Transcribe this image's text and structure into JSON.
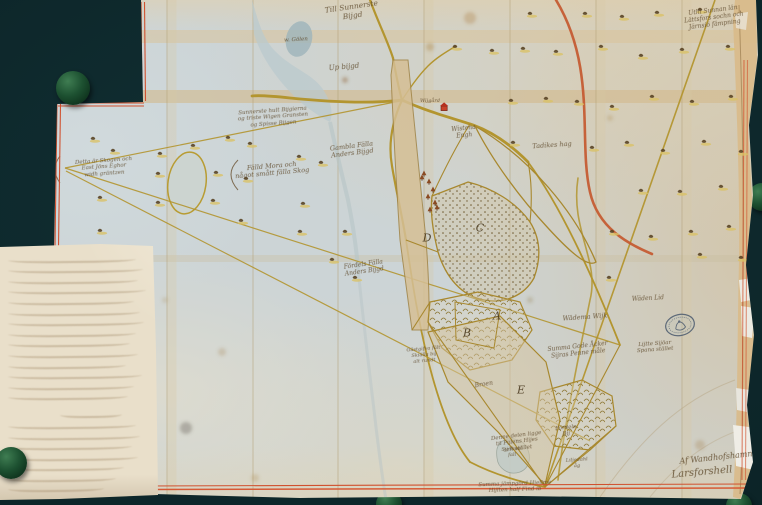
{
  "palette": {
    "background": "#081c1f",
    "background_highlight": "#123135",
    "paper_blue": "#ccd4d6",
    "paper_cream": "#e2cba0",
    "note_cream": "#e9dfca",
    "border_red": "#d0512f",
    "road_yellow": "#b3952f",
    "road_red": "#c55c33",
    "ink_brown": "#5f4a2c",
    "disc_green": "#1d5131",
    "stamp_blue": "#4a5a6e"
  },
  "map_sheet": {
    "labels": [
      {
        "x": 352,
        "y": 3,
        "s": 7.5,
        "r": -8,
        "lines": [
          "Till Sunnerste",
          "Bijgd"
        ]
      },
      {
        "x": 714,
        "y": 8,
        "s": 6,
        "r": -7,
        "lines": [
          "Uthi Sunnan län",
          "Lättsfors sochn och",
          "Järnsiö fämpning"
        ]
      },
      {
        "x": 344,
        "y": 63,
        "s": 7,
        "r": -5,
        "lines": [
          "Up bijgd"
        ]
      },
      {
        "x": 296,
        "y": 37,
        "s": 5.5,
        "r": -3,
        "lines": [
          "w. Gölen"
        ]
      },
      {
        "x": 273,
        "y": 108,
        "s": 5.5,
        "r": -4,
        "lines": [
          "Sunnerste hult Bijgierna",
          "og triste Wigen Gransten",
          "og Spisse Bijgen"
        ]
      },
      {
        "x": 104,
        "y": 158,
        "s": 5.5,
        "r": -4,
        "lines": [
          "Detta är Skogen och",
          "East Jöns Eghor",
          "widh gräntzen"
        ]
      },
      {
        "x": 272,
        "y": 163,
        "s": 6.5,
        "r": -5,
        "lines": [
          "Fälld Mora och",
          "något smått fälla Skog"
        ]
      },
      {
        "x": 352,
        "y": 143,
        "s": 6.5,
        "r": -7,
        "lines": [
          "Gambla Fälla",
          "Anders Bijgd"
        ]
      },
      {
        "x": 464,
        "y": 126,
        "s": 6,
        "r": -6,
        "lines": [
          "Wistena",
          "Engh"
        ]
      },
      {
        "x": 552,
        "y": 142,
        "s": 6.5,
        "r": -4,
        "lines": [
          "Tadikes hag"
        ]
      },
      {
        "x": 364,
        "y": 262,
        "s": 6,
        "r": -8,
        "lines": [
          "Fördels Fälla",
          "Anders Bijgd"
        ]
      },
      {
        "x": 585,
        "y": 314,
        "s": 6.5,
        "r": -4,
        "lines": [
          "Wädema Wijk"
        ]
      },
      {
        "x": 578,
        "y": 344,
        "s": 6,
        "r": -6,
        "lines": [
          "Summa Gode Åcker",
          "Sijras Penne måle"
        ]
      },
      {
        "x": 517,
        "y": 433,
        "s": 5.5,
        "r": -7,
        "lines": [
          "Denne delen ligge",
          "til Pijlens Hijes",
          "och stället"
        ]
      },
      {
        "x": 716,
        "y": 453,
        "s": 8,
        "r": -6,
        "lines": [
          "Af Wandhofshamn"
        ]
      },
      {
        "x": 702,
        "y": 467,
        "s": 10,
        "r": -5,
        "lines": [
          "Larsforshell"
        ]
      },
      {
        "x": 515,
        "y": 481,
        "s": 5.5,
        "r": -2,
        "lines": [
          "Summa jämpgörd Hiellme",
          "Hijlten half Find ib"
        ]
      },
      {
        "x": 430,
        "y": 99,
        "s": 5,
        "r": 0,
        "lines": [
          "Wijgård"
        ]
      },
      {
        "x": 424,
        "y": 347,
        "s": 5,
        "r": -5,
        "lines": [
          "Gästgifva fält",
          "Skiälla bij",
          "alt rundt"
        ]
      },
      {
        "x": 484,
        "y": 382,
        "s": 6,
        "r": -9,
        "lines": [
          "Broen"
        ]
      },
      {
        "x": 566,
        "y": 425,
        "s": 5.5,
        "r": -6,
        "lines": [
          "Fördels",
          "Bij"
        ]
      },
      {
        "x": 512,
        "y": 447,
        "s": 5,
        "r": -4,
        "lines": [
          "Sijöhual",
          "fall"
        ]
      },
      {
        "x": 577,
        "y": 458,
        "s": 5,
        "r": -4,
        "lines": [
          "Liljedahl",
          "åg"
        ]
      },
      {
        "x": 648,
        "y": 296,
        "s": 6,
        "r": -3,
        "lines": [
          "Wäden Lid"
        ]
      },
      {
        "x": 655,
        "y": 341,
        "s": 5.5,
        "r": -4,
        "lines": [
          "Lijtte Sijöar",
          "Spana stället"
        ]
      }
    ],
    "parcel_letters": [
      {
        "x": 480,
        "y": 228,
        "c": "C"
      },
      {
        "x": 427,
        "y": 238,
        "c": "D"
      },
      {
        "x": 497,
        "y": 316,
        "c": "A"
      },
      {
        "x": 467,
        "y": 333,
        "c": "B"
      },
      {
        "x": 521,
        "y": 390,
        "c": "E"
      }
    ],
    "trees": [
      [
        530,
        13
      ],
      [
        585,
        13
      ],
      [
        622,
        16
      ],
      [
        657,
        12
      ],
      [
        700,
        9
      ],
      [
        455,
        46
      ],
      [
        492,
        50
      ],
      [
        523,
        48
      ],
      [
        556,
        51
      ],
      [
        601,
        46
      ],
      [
        641,
        55
      ],
      [
        682,
        49
      ],
      [
        728,
        46
      ],
      [
        511,
        100
      ],
      [
        546,
        98
      ],
      [
        577,
        101
      ],
      [
        612,
        106
      ],
      [
        652,
        96
      ],
      [
        692,
        101
      ],
      [
        731,
        96
      ],
      [
        513,
        142
      ],
      [
        592,
        147
      ],
      [
        627,
        142
      ],
      [
        663,
        150
      ],
      [
        704,
        141
      ],
      [
        741,
        151
      ],
      [
        641,
        190
      ],
      [
        680,
        191
      ],
      [
        721,
        186
      ],
      [
        612,
        231
      ],
      [
        651,
        236
      ],
      [
        691,
        231
      ],
      [
        729,
        226
      ],
      [
        700,
        254
      ],
      [
        741,
        257
      ],
      [
        609,
        277
      ],
      [
        93,
        138
      ],
      [
        113,
        150
      ],
      [
        160,
        153
      ],
      [
        193,
        145
      ],
      [
        228,
        137
      ],
      [
        250,
        143
      ],
      [
        158,
        173
      ],
      [
        216,
        172
      ],
      [
        246,
        178
      ],
      [
        100,
        197
      ],
      [
        158,
        202
      ],
      [
        213,
        200
      ],
      [
        241,
        220
      ],
      [
        100,
        230
      ],
      [
        299,
        156
      ],
      [
        321,
        162
      ],
      [
        303,
        203
      ],
      [
        300,
        231
      ],
      [
        345,
        231
      ],
      [
        332,
        259
      ],
      [
        355,
        277
      ]
    ],
    "red_trees": [
      [
        424,
        175
      ],
      [
        429,
        183
      ],
      [
        433,
        191
      ],
      [
        428,
        198
      ],
      [
        435,
        204
      ],
      [
        430,
        211
      ],
      [
        437,
        209
      ],
      [
        422,
        179
      ]
    ]
  },
  "note_paper": {
    "row_widths": [
      128,
      135,
      130,
      138,
      126,
      132,
      136,
      128,
      122,
      130,
      118,
      134,
      126,
      120,
      62,
      128,
      132,
      124,
      130,
      116,
      108,
      96,
      60,
      40
    ]
  },
  "discs": [
    {
      "x": 73,
      "y": 88,
      "r": 17,
      "front": true
    },
    {
      "x": 11,
      "y": 463,
      "r": 16,
      "front": true
    },
    {
      "x": 762,
      "y": 197,
      "r": 14,
      "front": false
    },
    {
      "x": 389,
      "y": 504,
      "r": 13,
      "front": false
    },
    {
      "x": 739,
      "y": 506,
      "r": 13,
      "front": false
    }
  ]
}
